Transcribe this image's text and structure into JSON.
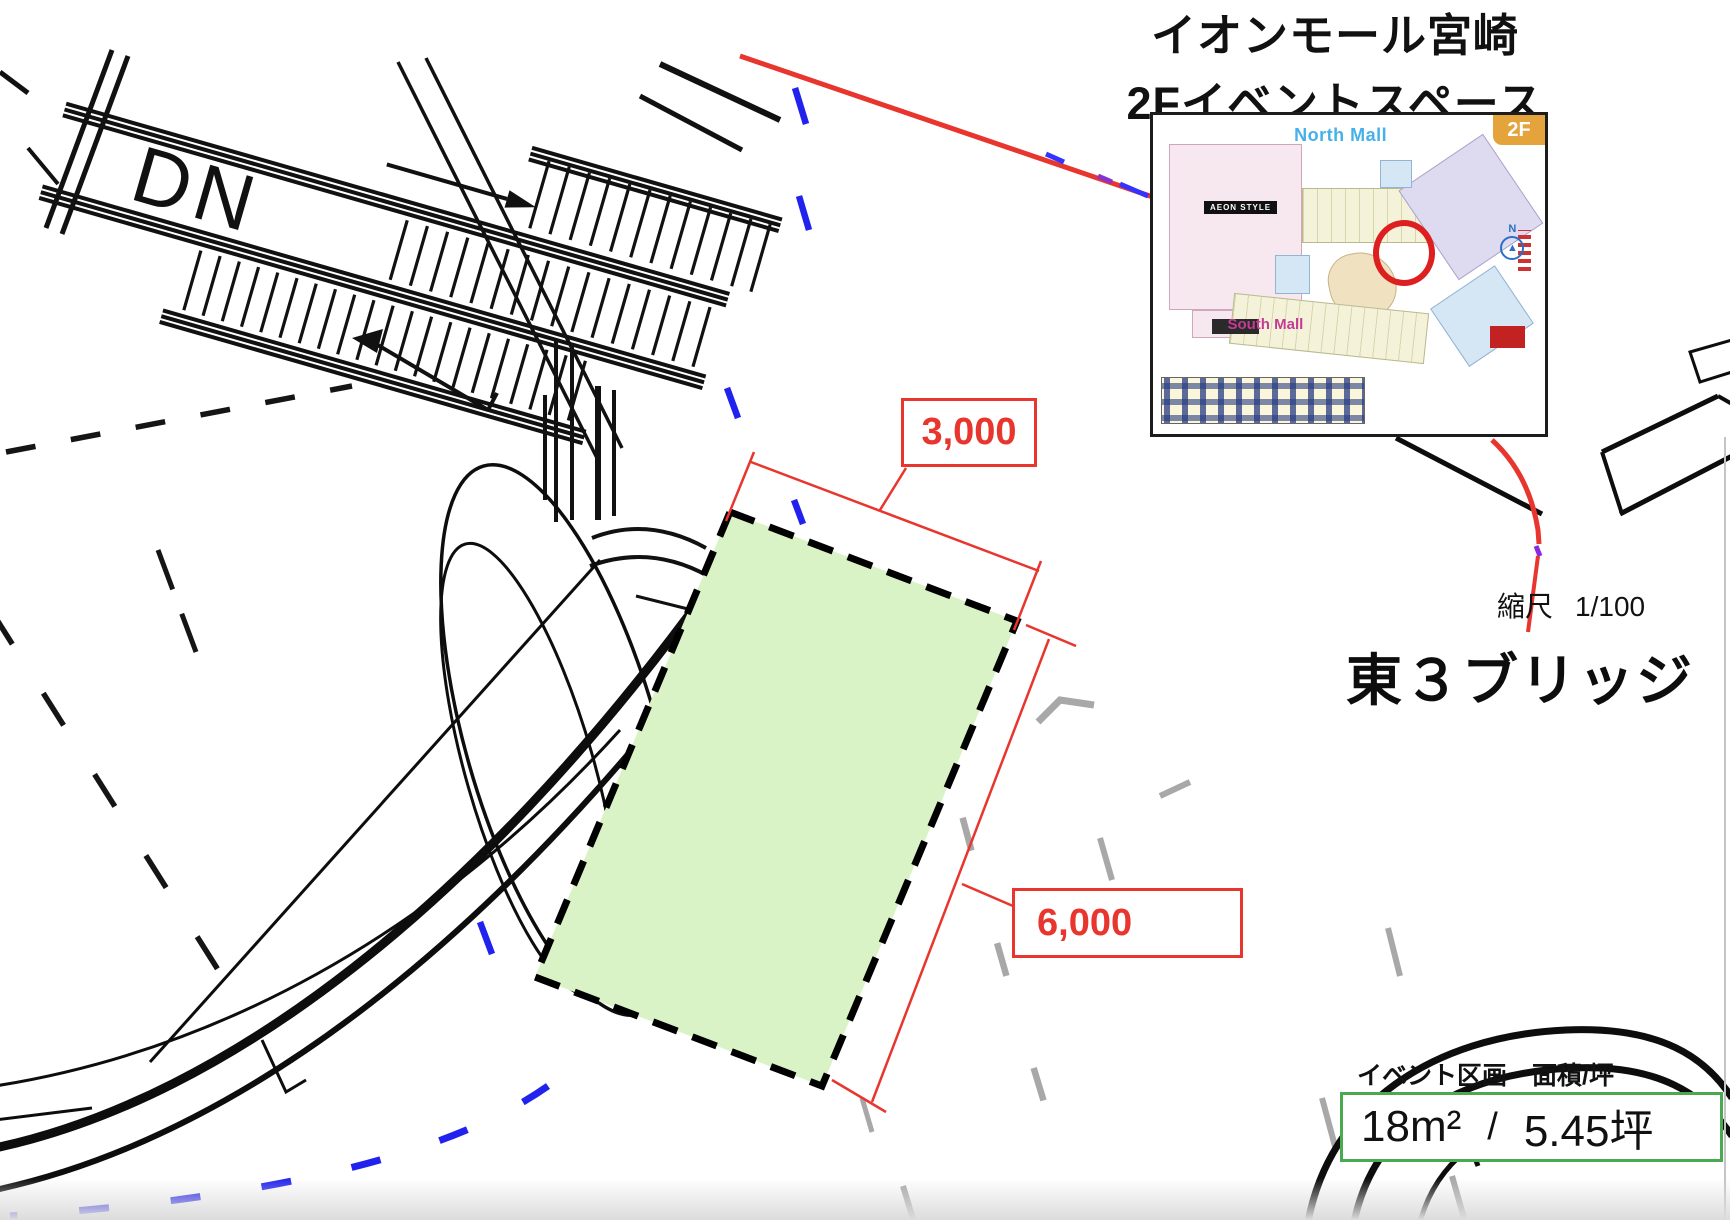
{
  "header": {
    "title_line1": "イオンモール宮崎",
    "title_line2": "2Fイベントスペース"
  },
  "map_inset": {
    "floor_badge": "2F",
    "north_label": "North Mall",
    "south_label": "South Mall",
    "store_label": "AEON STYLE",
    "compass_label": "N"
  },
  "scale": {
    "label": "縮尺",
    "value": "1/100"
  },
  "location_title": "東３ブリッジ",
  "plan": {
    "dn_label": "DN",
    "dim_width": "3,000",
    "dim_depth": "6,000",
    "colors": {
      "event_fill": "#d9f3c6",
      "dimension_red": "#e8362e",
      "route_red": "#e8362e",
      "guide_blue": "#2222ee",
      "guide_gray": "#a8a8a8"
    }
  },
  "event_info": {
    "label": "イベント区画　面積/坪",
    "area_sqm": "18m²",
    "separator": "/",
    "area_tsubo": "5.45坪",
    "box_border_color": "#4aaa50"
  }
}
